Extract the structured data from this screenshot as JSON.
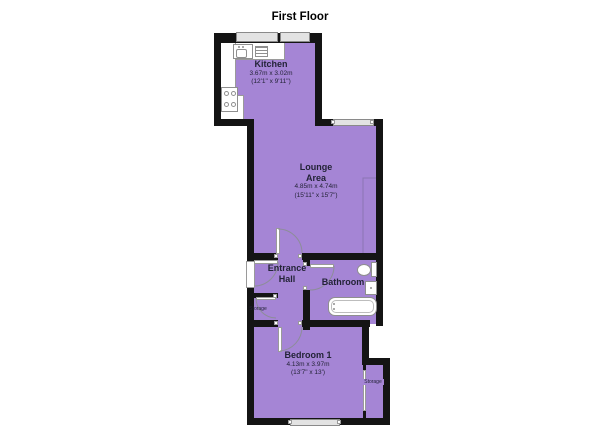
{
  "title": "First Floor",
  "colors": {
    "room_fill": "#a585d5",
    "wall": "#141414",
    "window_fill": "#e3e3e3",
    "fixture_fill": "#ffffff",
    "door_arc": "#8d8d99",
    "recess_line": "#8b75b2",
    "label_text": "#232337"
  },
  "rooms": {
    "kitchen": {
      "name": "Kitchen",
      "dims_metric": "3.67m x 3.02m",
      "dims_imperial": "(12'1\" x 9'11\")"
    },
    "lounge": {
      "name_line1": "Lounge",
      "name_line2": "Area",
      "dims_metric": "4.85m x 4.74m",
      "dims_imperial": "(15'11\" x 15'7\")"
    },
    "entrance_hall": {
      "name_line1": "Entrance",
      "name_line2": "Hall"
    },
    "bathroom": {
      "name": "Bathroom"
    },
    "bedroom1": {
      "name": "Bedroom 1",
      "dims_metric": "4.13m x 3.97m",
      "dims_imperial": "(13'7\" x 13')"
    },
    "hall_storage": {
      "name": "Storage"
    },
    "bedroom_storage": {
      "name": "Storage"
    }
  },
  "fixtures": {
    "kitchen": [
      "sink",
      "drainer",
      "cooker-hob"
    ],
    "bathroom": [
      "toilet",
      "basin",
      "bathtub"
    ]
  }
}
